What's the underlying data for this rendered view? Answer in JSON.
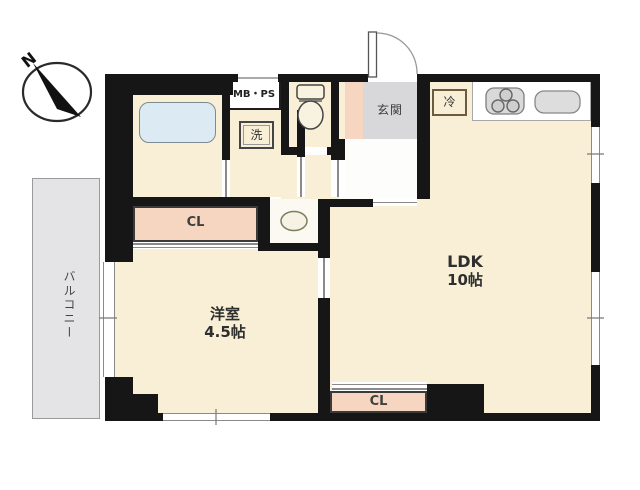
{
  "title": "apartment floor plan",
  "compass": {
    "label": "N"
  },
  "balcony": {
    "label": "バルコニー"
  },
  "rooms": {
    "ldk": {
      "name": "LDK",
      "size": "10帖"
    },
    "western": {
      "name": "洋室",
      "size": "4.5帖"
    },
    "entrance": {
      "label": "玄関"
    },
    "closet_top": {
      "label": "CL"
    },
    "closet_bottom": {
      "label": "CL"
    },
    "meter_box": {
      "label": "MB・PS"
    },
    "washer": {
      "label": "洗"
    },
    "fridge": {
      "label": "冷"
    }
  },
  "colors": {
    "wall": "#161616",
    "room_cream": "#f9efd7",
    "closet_salmon": "#f6d6c1",
    "entrance_gray": "#d8d8da",
    "balcony_gray": "#e4e4e6",
    "tub_blue": "#dcebf3"
  }
}
